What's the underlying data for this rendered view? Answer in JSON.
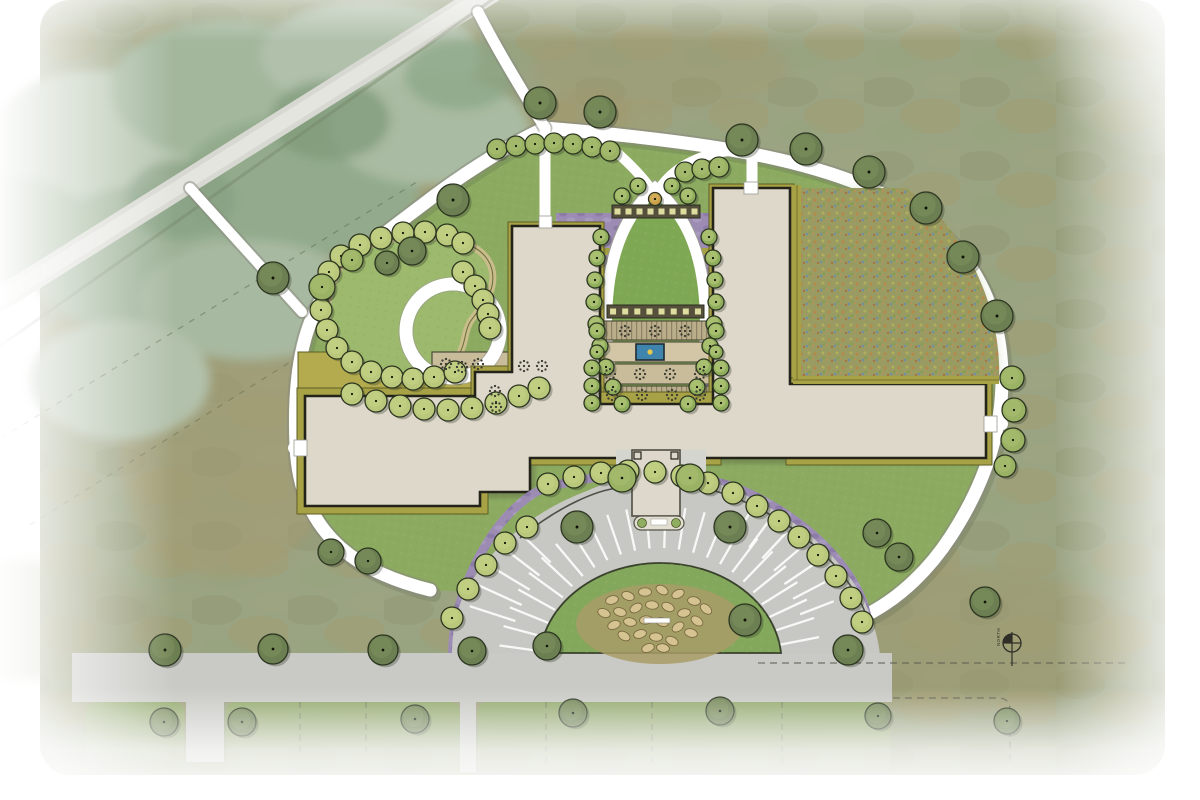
{
  "title": "campus-site-plan-rendering",
  "north_arrow": {
    "label": "NORTH"
  },
  "palette": {
    "field": "#9aa382",
    "lawn": "#8cab61",
    "lawn_light": "#9cb96d",
    "meadow_base": "#9e9763",
    "building_fill": "#ded8ca",
    "building_outline": "#23231a",
    "hedge_olive": "#a8a246",
    "hedge_olive_dark": "#5e5e24",
    "purple_bed": "#9c8cb4",
    "purple_bed_dark": "#8a78a4",
    "path_white": "#ffffff",
    "path_edge": "#8a8a80",
    "pavement": "#c7c7c3",
    "walk_light": "#d5d5cf",
    "deck_tan": "#b9ad8a",
    "terrace_tan": "#c8bc9b",
    "pergola_dark": "#55503c",
    "pergola_square": "#dedc9e",
    "pool_blue": "#3f84ad",
    "pool_dot": "#e8c84a",
    "tree_dark": "#6c7f52",
    "tree_dark_hi": "#83965f",
    "tree_med": "#9ab263",
    "tree_med_hi": "#aec277",
    "shrub_light": "#b9c87a",
    "shrub_light_hi": "#cbd78c",
    "vesica_shrub": "#8fae5c",
    "orange_tree": "#c8a04a",
    "boulder": "#d6c392",
    "boulder_edge": "#7a6a42",
    "mound": "#a89c66",
    "island_green": "#83a85c",
    "curb_dark": "#2f2f28",
    "dash_line": "#55554a"
  },
  "map": {
    "trees_dark": {
      "default_r": 16,
      "pts": [
        [
          540,
          103
        ],
        [
          600,
          112
        ],
        [
          742,
          140
        ],
        [
          806,
          149
        ],
        [
          869,
          172
        ],
        [
          926,
          208
        ],
        [
          963,
          257
        ],
        [
          997,
          316
        ],
        [
          453,
          200
        ],
        [
          412,
          251,
          14
        ],
        [
          387,
          263,
          12
        ],
        [
          273,
          278
        ],
        [
          331,
          552,
          13
        ],
        [
          368,
          561,
          13
        ],
        [
          165,
          650
        ],
        [
          273,
          649,
          15
        ],
        [
          383,
          650,
          15
        ],
        [
          472,
          651,
          14
        ],
        [
          547,
          646,
          14
        ],
        [
          577,
          527
        ],
        [
          730,
          527
        ],
        [
          745,
          620,
          16
        ],
        [
          848,
          650,
          15
        ],
        [
          877,
          533,
          14
        ],
        [
          899,
          557,
          14
        ],
        [
          985,
          602,
          15
        ],
        [
          164,
          722,
          14
        ],
        [
          242,
          722,
          14
        ],
        [
          415,
          719,
          14
        ],
        [
          573,
          713,
          14
        ],
        [
          720,
          711,
          14
        ],
        [
          878,
          716,
          13
        ],
        [
          1007,
          721,
          13
        ]
      ]
    },
    "trees_medium": {
      "default_r": 13,
      "pts": [
        [
          322,
          287
        ],
        [
          352,
          260,
          11
        ],
        [
          497,
          149,
          10
        ],
        [
          516,
          146,
          10
        ],
        [
          535,
          144,
          10
        ],
        [
          554,
          143,
          10
        ],
        [
          573,
          144,
          10
        ],
        [
          592,
          147,
          10
        ],
        [
          610,
          151,
          10
        ],
        [
          685,
          172,
          10
        ],
        [
          702,
          169,
          10
        ],
        [
          719,
          167,
          10
        ],
        [
          1012,
          378,
          12
        ],
        [
          1014,
          410,
          12
        ],
        [
          1013,
          440,
          12
        ],
        [
          1005,
          466,
          11
        ],
        [
          622,
          478,
          14
        ],
        [
          690,
          478,
          14
        ]
      ]
    },
    "shrubs_garden": {
      "default_r": 11,
      "pts": [
        [
          360,
          245
        ],
        [
          341,
          256
        ],
        [
          329,
          272
        ],
        [
          322,
          290
        ],
        [
          321,
          310
        ],
        [
          327,
          330
        ],
        [
          337,
          348
        ],
        [
          352,
          362
        ],
        [
          371,
          372
        ],
        [
          392,
          377
        ],
        [
          413,
          379
        ],
        [
          434,
          377
        ],
        [
          455,
          372
        ],
        [
          381,
          238
        ],
        [
          403,
          233
        ],
        [
          425,
          232
        ],
        [
          447,
          235
        ],
        [
          463,
          243
        ],
        [
          463,
          272
        ],
        [
          475,
          286
        ],
        [
          483,
          300
        ],
        [
          488,
          314
        ],
        [
          490,
          328
        ],
        [
          352,
          394
        ],
        [
          376,
          401
        ],
        [
          400,
          406
        ],
        [
          424,
          409
        ],
        [
          448,
          410
        ],
        [
          472,
          408
        ],
        [
          496,
          403
        ],
        [
          519,
          396
        ],
        [
          539,
          388
        ]
      ]
    },
    "shrubs_bed": {
      "default_r": 11,
      "pts": [
        [
          527,
          527
        ],
        [
          505,
          543
        ],
        [
          486,
          565
        ],
        [
          468,
          589
        ],
        [
          452,
          618
        ],
        [
          548,
          484
        ],
        [
          574,
          477
        ],
        [
          601,
          473
        ],
        [
          628,
          471
        ],
        [
          655,
          472
        ],
        [
          682,
          476
        ],
        [
          708,
          483
        ],
        [
          733,
          493
        ],
        [
          757,
          506
        ],
        [
          779,
          521
        ],
        [
          799,
          537
        ],
        [
          818,
          555
        ],
        [
          836,
          576
        ],
        [
          851,
          598
        ],
        [
          862,
          622
        ]
      ]
    },
    "shrubs_vesica": {
      "default_r": 8,
      "pts": [
        [
          601,
          237
        ],
        [
          597,
          258
        ],
        [
          595,
          280
        ],
        [
          594,
          302
        ],
        [
          596,
          324
        ],
        [
          600,
          346
        ],
        [
          606,
          367
        ],
        [
          613,
          387
        ],
        [
          622,
          404
        ],
        [
          709,
          237
        ],
        [
          713,
          258
        ],
        [
          715,
          280
        ],
        [
          716,
          302
        ],
        [
          714,
          324
        ],
        [
          710,
          346
        ],
        [
          704,
          367
        ],
        [
          697,
          387
        ],
        [
          688,
          404
        ],
        [
          622,
          196
        ],
        [
          638,
          186
        ],
        [
          672,
          186
        ],
        [
          688,
          196
        ],
        [
          592,
          368
        ],
        [
          592,
          386
        ],
        [
          592,
          403
        ],
        [
          721,
          368
        ],
        [
          721,
          386
        ],
        [
          721,
          403
        ],
        [
          597,
          331
        ],
        [
          716,
          331
        ],
        [
          597,
          352,
          7
        ],
        [
          716,
          352,
          7
        ]
      ]
    },
    "orange_tree": [
      655,
      199,
      6.5
    ],
    "boulders": [
      [
        612,
        600,
        -15
      ],
      [
        628,
        596,
        20
      ],
      [
        645,
        592,
        0
      ],
      [
        662,
        590,
        30
      ],
      [
        678,
        594,
        -25
      ],
      [
        694,
        601,
        10
      ],
      [
        706,
        609,
        40
      ],
      [
        620,
        612,
        15
      ],
      [
        636,
        608,
        -30
      ],
      [
        652,
        605,
        5
      ],
      [
        668,
        607,
        25
      ],
      [
        684,
        613,
        -10
      ],
      [
        697,
        621,
        35
      ],
      [
        614,
        625,
        -20
      ],
      [
        630,
        622,
        10
      ],
      [
        646,
        620,
        -5
      ],
      [
        662,
        622,
        20
      ],
      [
        678,
        627,
        -35
      ],
      [
        691,
        633,
        15
      ],
      [
        624,
        636,
        30
      ],
      [
        640,
        634,
        -15
      ],
      [
        656,
        637,
        5
      ],
      [
        672,
        641,
        25
      ],
      [
        648,
        648,
        -20
      ],
      [
        663,
        648,
        10
      ],
      [
        604,
        613,
        22
      ]
    ],
    "planter_clusters": [
      [
        446,
        364
      ],
      [
        462,
        367
      ],
      [
        478,
        364
      ],
      [
        524,
        366
      ],
      [
        542,
        366
      ],
      [
        495,
        391
      ],
      [
        496,
        407
      ],
      [
        625,
        331
      ],
      [
        655,
        331
      ],
      [
        685,
        331
      ],
      [
        610,
        374
      ],
      [
        640,
        374
      ],
      [
        670,
        374
      ],
      [
        700,
        374
      ],
      [
        612,
        395
      ],
      [
        642,
        395
      ],
      [
        672,
        395
      ],
      [
        700,
        395
      ]
    ],
    "pergola_bars": [
      {
        "x": 612,
        "y": 205,
        "w": 88,
        "h": 13,
        "n": 8
      },
      {
        "x": 607,
        "y": 305,
        "w": 97,
        "h": 13,
        "n": 8
      }
    ],
    "stall_fans": [
      {
        "cx": 660,
        "cy": 668,
        "r1": 120,
        "r2": 162,
        "a1": 188,
        "a2": 352,
        "step": 7
      },
      {
        "cx": 660,
        "cy": 668,
        "r1": 150,
        "r2": 186,
        "a1": 300,
        "a2": 345,
        "step": 6.5
      },
      {
        "cx": 660,
        "cy": 668,
        "r1": 152,
        "r2": 200,
        "a1": 198,
        "a2": 228,
        "step": 6.5
      }
    ]
  }
}
